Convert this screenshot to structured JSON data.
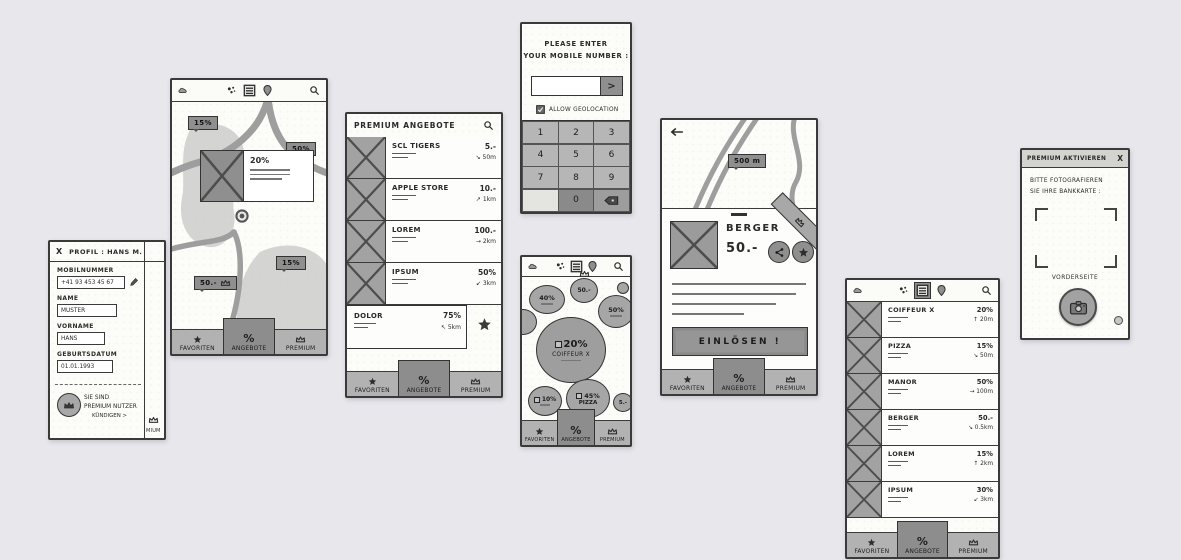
{
  "canvas": {
    "background": "#e7e7ec"
  },
  "nav": {
    "favorites": "FAVORITEN",
    "offers": "ANGEBOTE",
    "premium": "PREMIUM",
    "offers_icon": "%"
  },
  "profile": {
    "close": "X",
    "title": "PROFIL : HANS M.",
    "fields": [
      {
        "label": "MOBILNUMMER",
        "value": "+41 93 453 45 67"
      },
      {
        "label": "NAME",
        "value": "MUSTER"
      },
      {
        "label": "VORNAME",
        "value": "HANS"
      },
      {
        "label": "GEBURTSDATUM",
        "value": "01.01.1993"
      }
    ],
    "premium_line1": "SIE SIND",
    "premium_line2": "PREMIUM NUTZER",
    "cancel": "KÜNDIGEN >",
    "partial_nav": "MIUM"
  },
  "map": {
    "badge_topleft": "15%",
    "badge_right": "50%",
    "callout_value": "20%",
    "badge_bottom": "15%",
    "badge_premium": "50.-"
  },
  "premium_offers": {
    "title": "PREMIUM ANGEBOTE",
    "rows": [
      {
        "name": "SCL TIGERS",
        "price": "5.-",
        "distance": "↘ 50m"
      },
      {
        "name": "APPLE STORE",
        "price": "10.-",
        "distance": "↗ 1km"
      },
      {
        "name": "LOREM",
        "price": "100.-",
        "distance": "→ 2km"
      },
      {
        "name": "IPSUM",
        "price": "50%",
        "distance": "↙ 3km"
      },
      {
        "name": "DOLOR",
        "price": "75%",
        "distance": "↖ 5km"
      }
    ]
  },
  "mobile_number": {
    "prompt_line1": "PLEASE ENTER",
    "prompt_line2": "YOUR MOBILE NUMBER :",
    "input_value": "",
    "submit": ">",
    "geolocation": "ALLOW GEOLOCATION",
    "keys": [
      "1",
      "2",
      "3",
      "4",
      "5",
      "6",
      "7",
      "8",
      "9",
      "0"
    ]
  },
  "bubbles": {
    "b40": "40%",
    "b50chf": "50.-",
    "b50pct": "50%",
    "big_value": "20%",
    "big_name": "COIFFEUR X",
    "b10": "10%",
    "b45_value": "45%",
    "b45_name": "PIZZA",
    "b5": "5.-"
  },
  "offer_detail": {
    "distance_badge": "500 m",
    "title": "BERGER",
    "price": "50.-",
    "redeem": "EINLÖSEN !"
  },
  "offers_list": {
    "rows": [
      {
        "name": "COIFFEUR X",
        "value": "20%",
        "distance": "↑ 20m"
      },
      {
        "name": "PIZZA",
        "value": "15%",
        "distance": "↘ 50m"
      },
      {
        "name": "MANOR",
        "value": "50%",
        "distance": "→ 100m"
      },
      {
        "name": "BERGER",
        "value": "50.-",
        "distance": "↘ 0.5km"
      },
      {
        "name": "LOREM",
        "value": "15%",
        "distance": "↑ 2km"
      },
      {
        "name": "IPSUM",
        "value": "30%",
        "distance": "↙ 3km"
      }
    ]
  },
  "premium_activate": {
    "title": "PREMIUM AKTIVIEREN",
    "close": "X",
    "instruction_line1": "BITTE FOTOGRAFIEREN",
    "instruction_line2": "SIE IHRE BANKKARTE :",
    "side_label": "VORDERSEITE"
  }
}
